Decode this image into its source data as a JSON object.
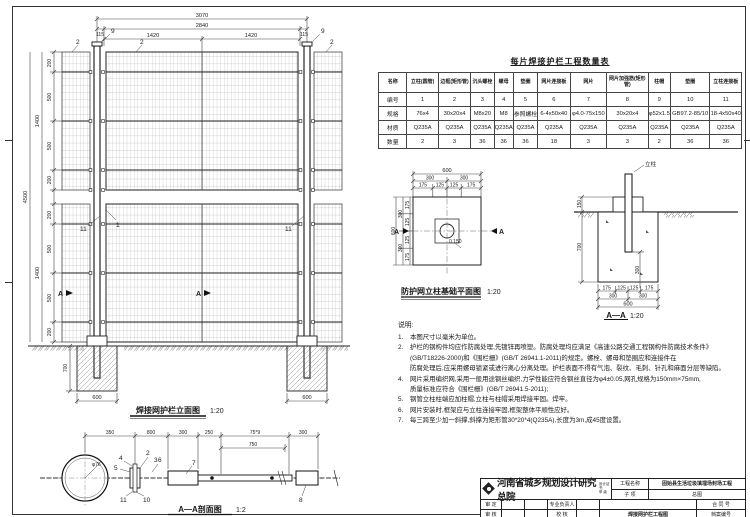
{
  "sheet": {
    "line_color": "#333333",
    "bg_color": "#ffffff"
  },
  "elevation": {
    "title": "焊接网护栏立面图",
    "scale": "1:20",
    "dims": {
      "overall_width": "3070",
      "inner_width": "2840",
      "edge": "115",
      "half_left": "1420",
      "half_right": "1420",
      "spacing": [
        "200",
        "500",
        "500",
        "200"
      ],
      "tier_height_upper": "1400",
      "tier_height_lower": "1400",
      "overall_height": "4500",
      "footing_depth": "700",
      "footing_width_left": "600",
      "footing_width_right": "600"
    },
    "callouts": {
      "mesh": "2",
      "cap": "9",
      "post": "1",
      "plate": "11",
      "section": "A"
    }
  },
  "table": {
    "title": "每片焊接护栏工程数量表",
    "row_headers": [
      "名称",
      "编号",
      "规格",
      "材质",
      "数量"
    ],
    "columns": [
      {
        "name": "立柱(圆管)",
        "no": "1",
        "spec": "76x4",
        "mat": "Q235A",
        "qty": "2"
      },
      {
        "name": "边框(矩形管)",
        "no": "2",
        "spec": "30x20x4",
        "mat": "Q235A",
        "qty": "3"
      },
      {
        "name": "沉头螺栓",
        "no": "3",
        "spec": "M8x20",
        "mat": "Q235A",
        "qty": "36"
      },
      {
        "name": "螺母",
        "no": "4",
        "spec": "M8",
        "mat": "Q235A",
        "qty": "36"
      },
      {
        "name": "垫圈",
        "no": "5",
        "spec": "参照螺栓",
        "mat": "Q235A",
        "qty": "36"
      },
      {
        "name": "网片连接板",
        "no": "6",
        "spec": "6-4x50x40",
        "mat": "Q235A",
        "qty": "18"
      },
      {
        "name": "网片",
        "no": "7",
        "spec": "φ4.0-75x150",
        "mat": "Q235A",
        "qty": "3"
      },
      {
        "name": "网片加强筋(矩形管)",
        "no": "8",
        "spec": "30x20x4",
        "mat": "Q235A",
        "qty": "3"
      },
      {
        "name": "柱帽",
        "no": "9",
        "spec": "φ52x1.5",
        "mat": "Q235A",
        "qty": "2"
      },
      {
        "name": "垫圈",
        "no": "10",
        "spec": "GB97.2-85/10",
        "mat": "Q235A",
        "qty": "36"
      },
      {
        "name": "立柱连接板",
        "no": "11",
        "spec": "18-4x50x40",
        "mat": "Q235A",
        "qty": "36"
      }
    ]
  },
  "foundation_plan": {
    "title": "防护网立柱基础平面图",
    "scale": "1:20",
    "dims": {
      "width": "600",
      "height": "600",
      "half": "300",
      "quarter_outer": "175",
      "quarter_inner": "125"
    },
    "level": "0.150",
    "section_label": "A"
  },
  "section_aa": {
    "title": "A—A",
    "scale": "1:20",
    "post_label": "立柱",
    "dims": {
      "above_ground": "150",
      "depth": "700",
      "embed": "300",
      "quarter_outer": "175",
      "quarter_inner": "125",
      "half": "300",
      "width": "600"
    }
  },
  "notes": {
    "heading": "说明:",
    "items": [
      {
        "no": "1.",
        "text": "本图尺寸以毫米为单位。"
      },
      {
        "no": "2.",
        "text": "护栏的钢构件均应作防腐处理,先镀锌再喷塑。防腐处理均应满足《高速公路交通工程钢构件防腐技术条件》"
      },
      {
        "no": "",
        "text": "(GB/T18226-2000)和《围栏栅》(GB/T 26941.1-2011)的规定。螺栓、螺母和垫圈应和连接件在"
      },
      {
        "no": "",
        "text": "防腐处理后,应采用螺母锁紧或进行离心分离处理。护栏表面不得有气泡、裂纹、毛刺、针孔和麻面分层等缺陷。"
      },
      {
        "no": "4.",
        "text": "网片采用编织网,采用一般用途钢丝编织,力学性能应符合钢丝直径为φ4±0.05,网孔规格为150mm×75mm,"
      },
      {
        "no": "",
        "text": "质量标准应符合《围栏栅》(GB/T 26941.5-2011);"
      },
      {
        "no": "5.",
        "text": "钢管立柱柱端应加柱帽,立柱与柱帽采用焊接牢固。焊牢。"
      },
      {
        "no": "6.",
        "text": "网片安装时,框架应与立柱连接牢固,框架整体平顺性应好。"
      },
      {
        "no": "7.",
        "text": "每三跨至少加一斜撑,斜撑为矩形管30*20*4(Q235A),长度为3m,成45度设置。"
      }
    ]
  },
  "detail_aa": {
    "title": "A—A剖面图",
    "scale": "1:2",
    "post_dia": "φ76",
    "dims": [
      "350",
      "800",
      "300",
      "250",
      "75*9",
      "300"
    ],
    "sub_dim": "750",
    "callouts": [
      "2",
      "3",
      "4",
      "5",
      "6",
      "7",
      "10",
      "11",
      "8"
    ]
  },
  "titleblock": {
    "institute": "河南省城乡规划设计研究总院",
    "cert_lines": [
      "设计证书",
      "甲  级"
    ],
    "project_label": "工程名称",
    "project": "固始县生活垃圾填埋场封场工程",
    "subitem_label": "子  项",
    "subitem": "总图",
    "approve_label": "审 定",
    "review_label": "审 核",
    "lead_label": "专业负责人",
    "check_label": "校 核",
    "drawing_name": "焊接网护栏工程图",
    "contract_label": "合 同 号",
    "archive_label": "档案编号",
    "sheet_label": "图 别",
    "number_label": "图 号"
  }
}
